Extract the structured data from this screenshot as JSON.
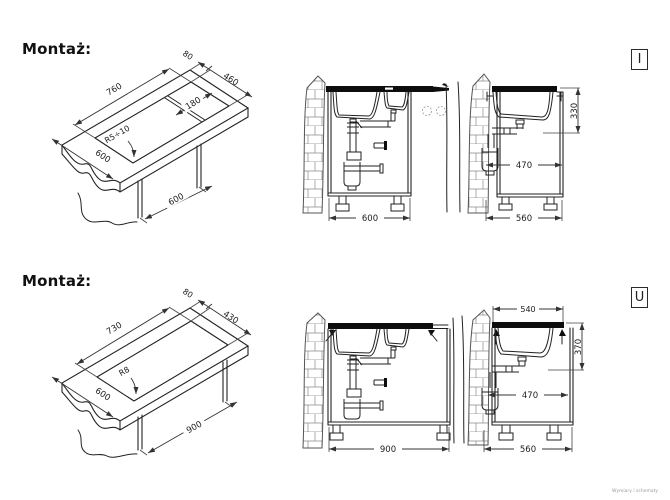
{
  "page": {
    "footnote": "Wymiary i schematy",
    "ink_color": "#222222",
    "dim_color": "#333333"
  },
  "sections": [
    {
      "label": "Montaż:",
      "variant": "I",
      "iso": {
        "length": "760",
        "edge": "80",
        "width": "460",
        "divider": "180",
        "radius": "R5÷10",
        "depth": "600",
        "cabinet_width": "600"
      },
      "front": {
        "width": "600"
      },
      "side": {
        "height": "330",
        "outlet": "470",
        "depth": "560"
      }
    },
    {
      "label": "Montaż:",
      "variant": "U",
      "iso": {
        "length": "730",
        "edge": "80",
        "width": "430",
        "radius": "R8",
        "depth": "600",
        "cabinet_width": "900"
      },
      "front": {
        "width": "900"
      },
      "side": {
        "top_width": "540",
        "height": "370",
        "outlet": "470",
        "depth": "560"
      }
    }
  ]
}
